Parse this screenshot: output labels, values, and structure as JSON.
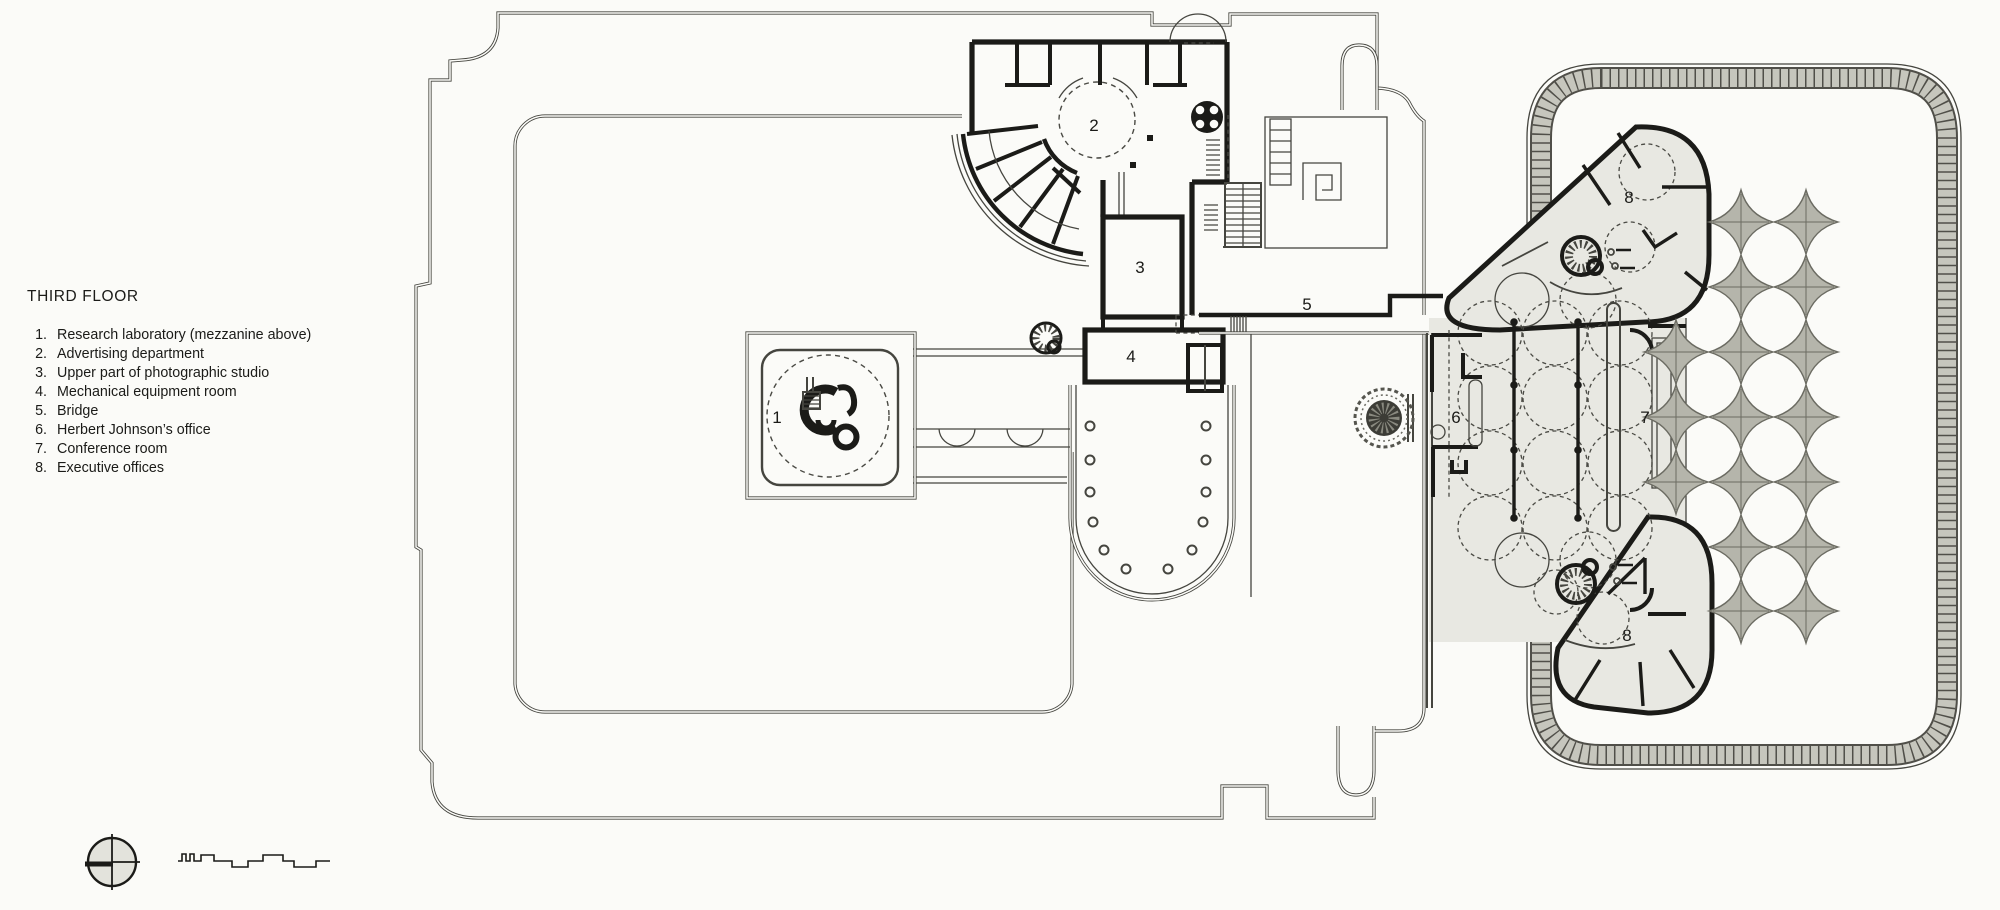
{
  "colors": {
    "paper": "#fbfbf8",
    "ink": "#1b1b18",
    "line": "#45453f",
    "dashcol": "#4a4a44",
    "grayfill": "#e8e8e2",
    "bandfill": "#c6c6bd",
    "bandedge": "#504f49",
    "starfill": "#b5b5ab",
    "staredge": "#6b6b62",
    "treefill": "#3c3c36",
    "compassfill": "#e3e3dc"
  },
  "legend": {
    "title": "THIRD FLOOR",
    "items": [
      {
        "num": "1.",
        "label": "Research laboratory (mezzanine above)"
      },
      {
        "num": "2.",
        "label": "Advertising department"
      },
      {
        "num": "3.",
        "label": "Upper part of photographic studio"
      },
      {
        "num": "4.",
        "label": "Mechanical equipment room"
      },
      {
        "num": "5.",
        "label": "Bridge"
      },
      {
        "num": "6.",
        "label": "Herbert Johnson’s office"
      },
      {
        "num": "7.",
        "label": "Conference room"
      },
      {
        "num": "8.",
        "label": "Executive offices"
      }
    ]
  },
  "plan": {
    "markers": [
      {
        "room": "research-laboratory",
        "text": "1"
      },
      {
        "room": "advertising-department",
        "text": "2"
      },
      {
        "room": "photographic-studio",
        "text": "3"
      },
      {
        "room": "mechanical-equipment-room",
        "text": "4"
      },
      {
        "room": "bridge",
        "text": "5"
      },
      {
        "room": "herbert-johnson-office",
        "text": "6"
      },
      {
        "room": "conference-room",
        "text": "7"
      },
      {
        "room": "executive-offices-upper",
        "text": "8"
      },
      {
        "room": "executive-offices-lower",
        "text": "8"
      }
    ]
  },
  "symbols": {
    "compass": "compass-rose",
    "scale_bar": "stepped-graphic-scale",
    "tree": "tree-planter",
    "spiral_stair": "spiral-stair",
    "elevator": "elevator-core",
    "columns": "mushroom-column-grid"
  }
}
